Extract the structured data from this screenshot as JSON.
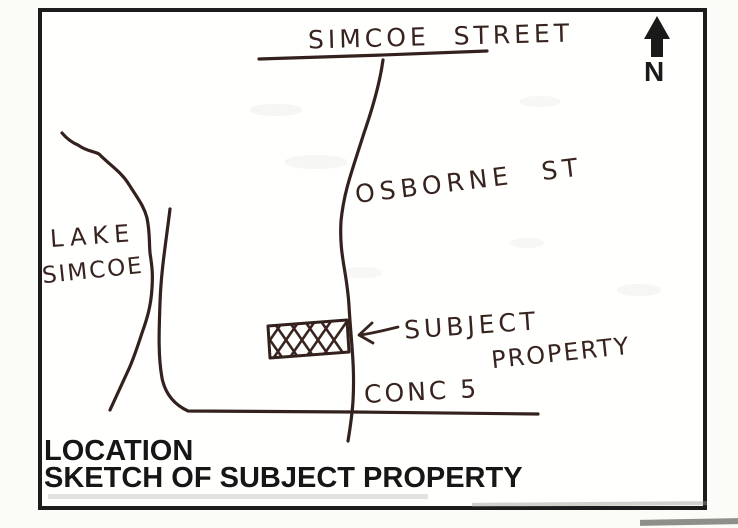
{
  "map": {
    "labels": {
      "simcoe_street": "SIMCOE STREET",
      "osborne_st": "OSBORNE ST",
      "lake_line1": "LAKE",
      "lake_line2": "SIMCOE",
      "subject_line1": "SUBJECT",
      "subject_line2": "PROPERTY",
      "conc5": "CONC 5",
      "north": "N"
    },
    "caption": {
      "line1": "LOCATION",
      "line2": "SKETCH OF SUBJECT PROPERTY"
    },
    "colors": {
      "ink": "#38241f",
      "print": "#161616",
      "border": "#1c1c1c",
      "paper": "#fffffe"
    },
    "icons": {
      "north_arrow": "north-arrow-icon",
      "subject_pointer": "left-arrow-icon"
    },
    "features": {
      "subject_property": "crosshatched rectangle on west side of Osborne St, north of Conc 5",
      "water_body": "Lake Simcoe shoreline on west side"
    }
  }
}
